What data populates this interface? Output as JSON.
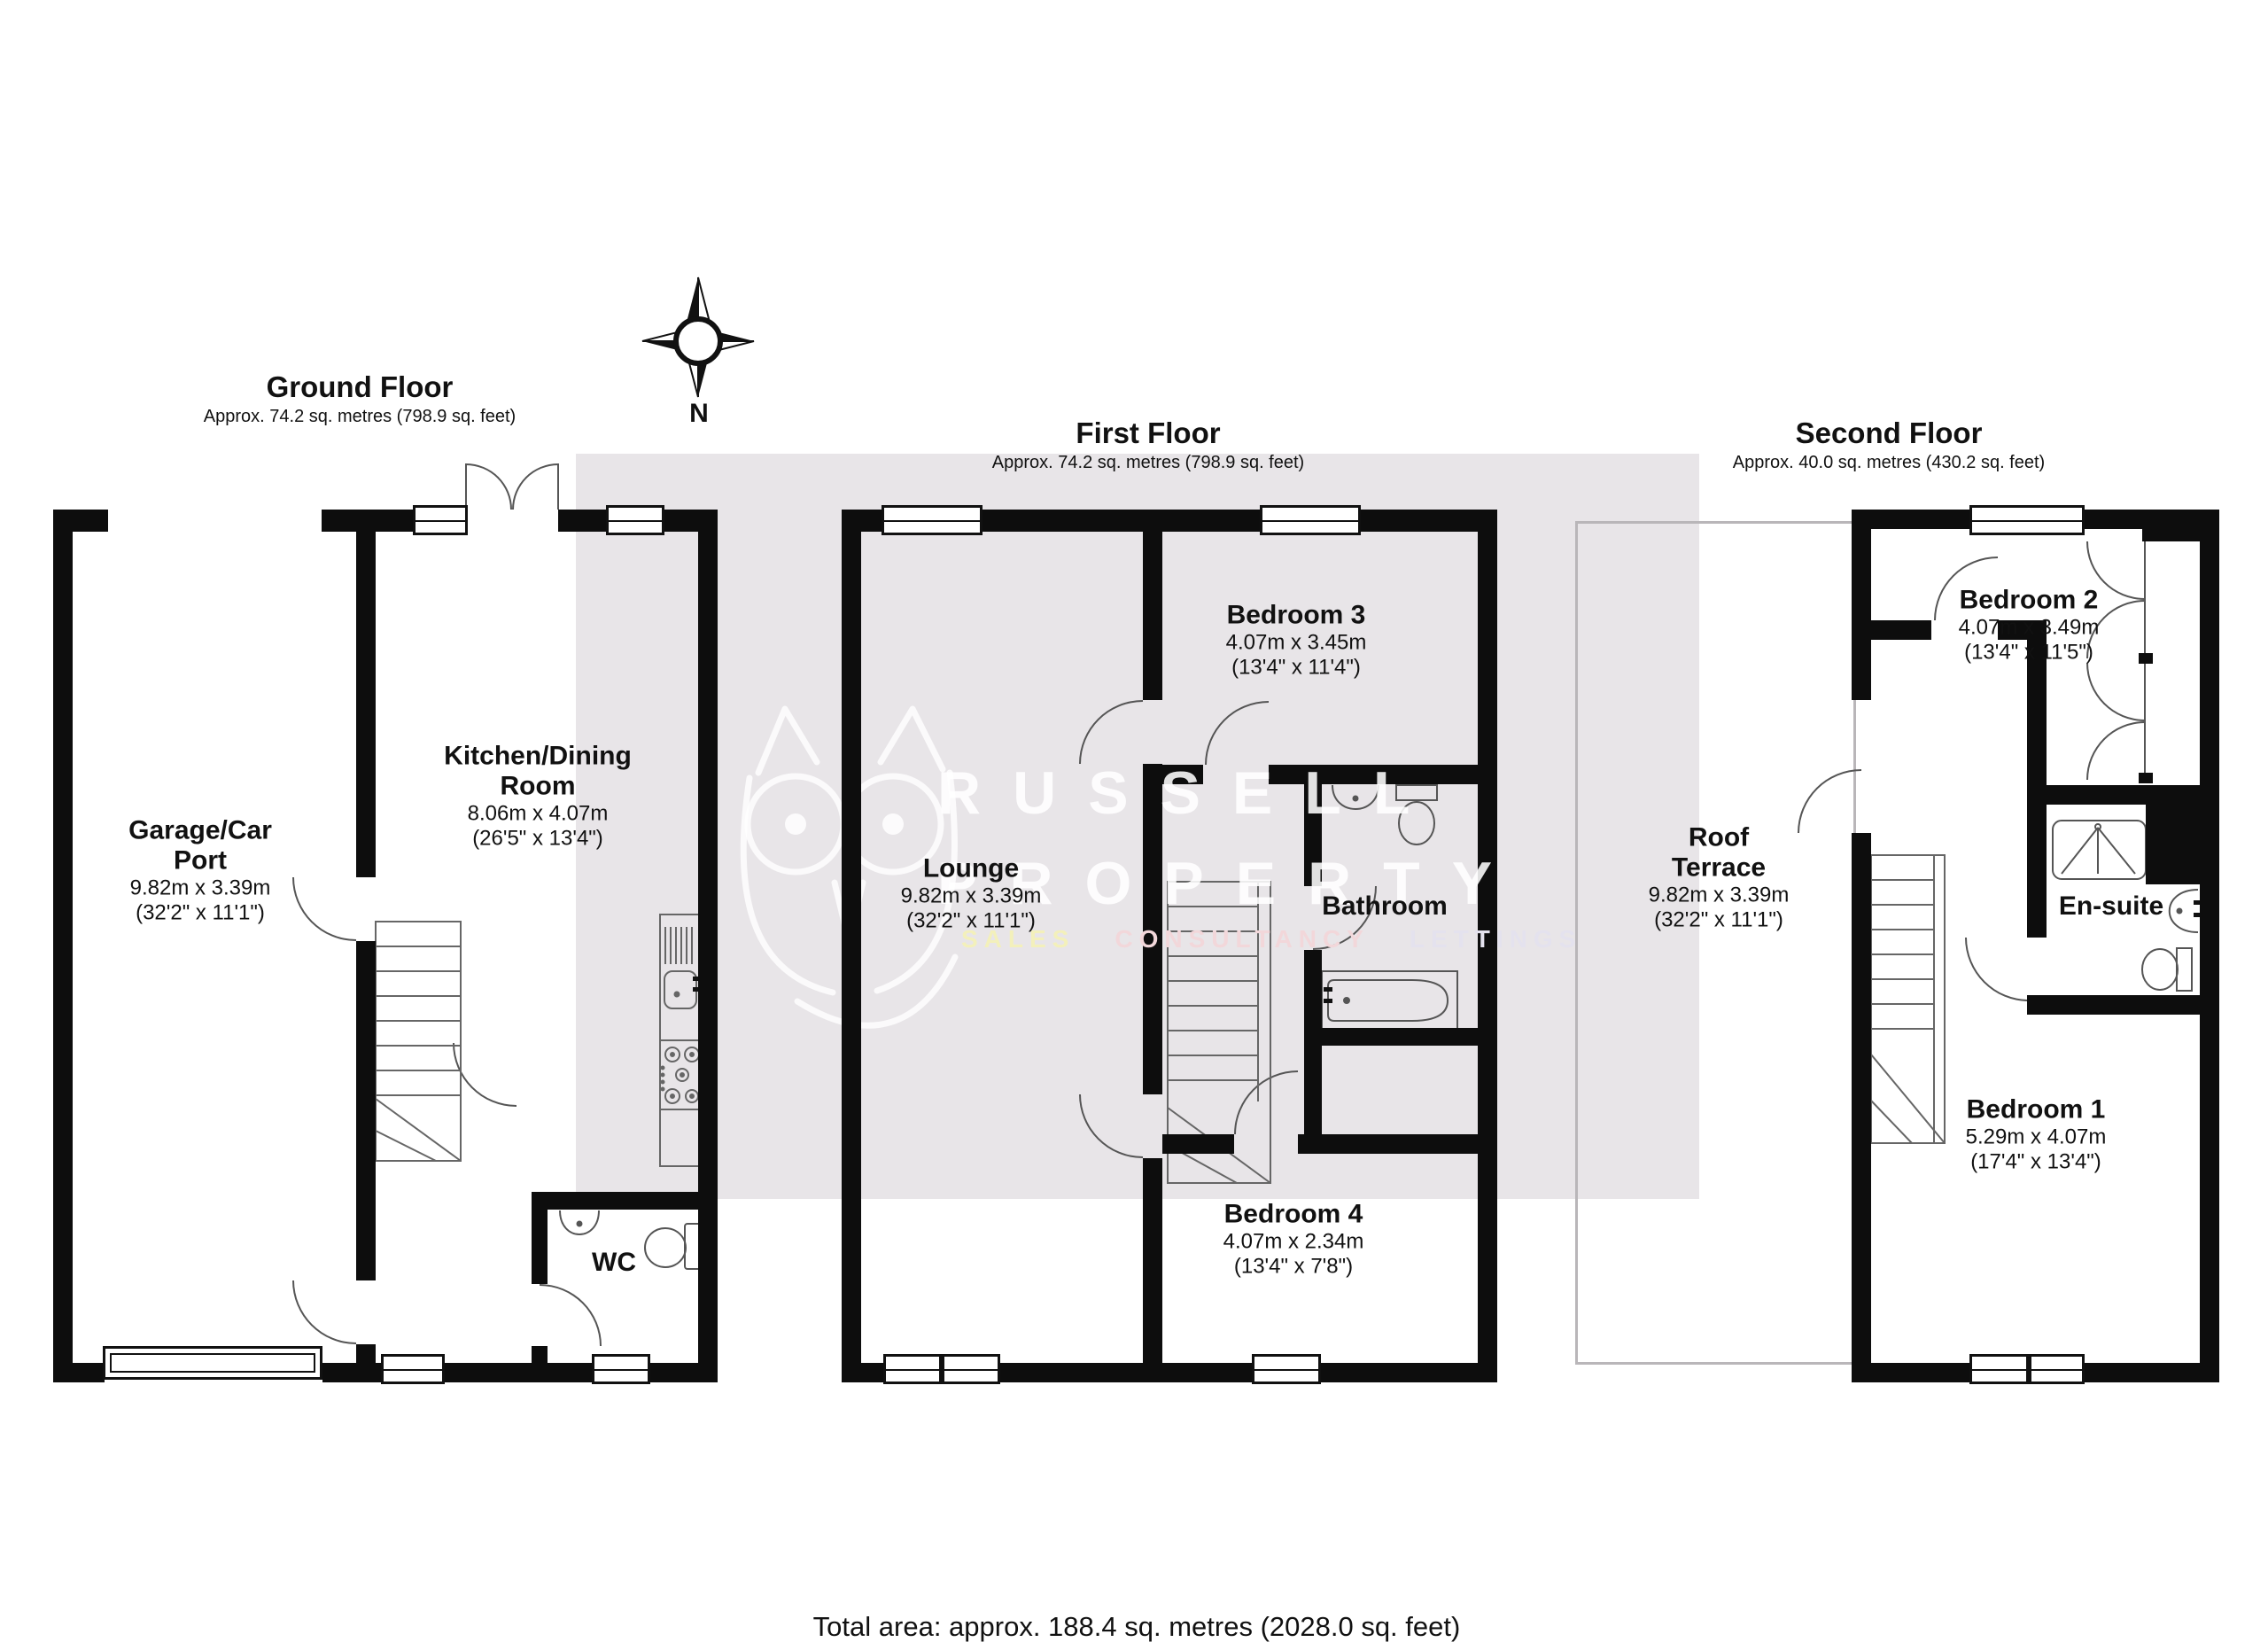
{
  "colors": {
    "wall": "#0d0d0d",
    "watermark_band": "#e8e5e8",
    "brand_text": "#ffffff",
    "sales": "#f3f0bb",
    "consultancy": "#f2d7da",
    "lettings": "#e4e2ee"
  },
  "floors": [
    {
      "title": "Ground Floor",
      "subtitle": "Approx. 74.2 sq. metres (798.9 sq. feet)"
    },
    {
      "title": "First Floor",
      "subtitle": "Approx. 74.2 sq. metres (798.9 sq. feet)"
    },
    {
      "title": "Second Floor",
      "subtitle": "Approx. 40.0 sq. metres (430.2 sq. feet)"
    }
  ],
  "rooms": {
    "garage": {
      "line1": "Garage/Car",
      "line2": "Port",
      "metric": "9.82m x 3.39m",
      "imperial": "(32'2\" x 11'1\")"
    },
    "kitchen": {
      "line1": "Kitchen/Dining",
      "line2": "Room",
      "metric": "8.06m x 4.07m",
      "imperial": "(26'5\" x 13'4\")"
    },
    "wc": {
      "line1": "WC"
    },
    "lounge": {
      "line1": "Lounge",
      "metric": "9.82m x 3.39m",
      "imperial": "(32'2\" x 11'1\")"
    },
    "bedroom3": {
      "line1": "Bedroom 3",
      "metric": "4.07m x 3.45m",
      "imperial": "(13'4\" x 11'4\")"
    },
    "bathroom": {
      "line1": "Bathroom"
    },
    "bedroom4": {
      "line1": "Bedroom 4",
      "metric": "4.07m x 2.34m",
      "imperial": "(13'4\" x 7'8\")"
    },
    "terrace": {
      "line1": "Roof",
      "line2": "Terrace",
      "metric": "9.82m x 3.39m",
      "imperial": "(32'2\" x 11'1\")"
    },
    "bedroom2": {
      "line1": "Bedroom 2",
      "metric": "4.07m x 3.49m",
      "imperial": "(13'4\" x 11'5\")"
    },
    "ensuite": {
      "line1": "En-suite"
    },
    "bedroom1": {
      "line1": "Bedroom 1",
      "metric": "5.29m x 4.07m",
      "imperial": "(17'4\" x 13'4\")"
    }
  },
  "compass": {
    "label": "N"
  },
  "watermark": {
    "brand_line1": "RUSSELL",
    "brand_line2": "PROPERTY",
    "tagline": [
      "SALES",
      "CONSULTANCY",
      "LETTINGS"
    ]
  },
  "footer": {
    "total_area": "Total area: approx. 188.4 sq. metres (2028.0 sq. feet)"
  }
}
